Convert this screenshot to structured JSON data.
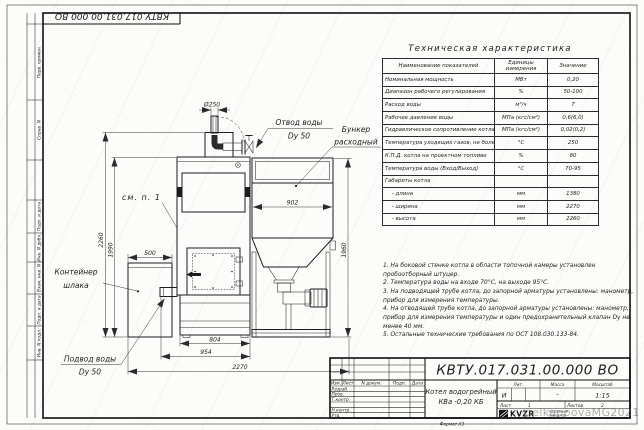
{
  "frame": {
    "top_doc_number": "КВТУ.017.031.00.000 ВО",
    "side_labels": [
      "Перв. примен.",
      "Справ. N",
      "Подп. и дата",
      "Инв. N дубл.",
      "Взам. инв. N",
      "Подп. и дата",
      "Инв. N подл."
    ]
  },
  "spec_table": {
    "title": "Техническая характеристика",
    "columns": [
      "Наименование показателей",
      "Единицы измерения",
      "Значение"
    ],
    "rows": [
      [
        "Номинальная мощность",
        "МВт",
        "0,20"
      ],
      [
        "Диапазон рабочего регулирования",
        "%",
        "50-100"
      ],
      [
        "Расход воды",
        "м³/ч",
        "7"
      ],
      [
        "Рабочее давление воды",
        "МПа (кгс/см²)",
        "0,6(6,0)"
      ],
      [
        "Гидравлическое сопротивление котла",
        "МПа (кгс/см²)",
        "0,02(0,2)"
      ],
      [
        "Температура уходящих газов, не более",
        "°С",
        "250"
      ],
      [
        "К.П.Д. котла на проектном топливе",
        "%",
        "80"
      ],
      [
        "Температура воды (Вход/Выход)",
        "°С",
        "70-95"
      ],
      [
        "Габариты котла",
        "",
        ""
      ],
      [
        "    - длина",
        "мм",
        "1380"
      ],
      [
        "    - ширина",
        "мм",
        "2270"
      ],
      [
        "    - высота",
        "мм",
        "2260"
      ]
    ]
  },
  "notes": [
    "1. На боковой стенке котла в области топочной камеры установлен пробоотборный штуцер.",
    "2. Температура воды на входе 70°С, на выходе 95°С.",
    "3. На подводящей трубе котла, до запорной арматуры установлены: манометр, прибор для измерения температуры.",
    "4. На отводящей трубе котла, до запорной арматуры установлены: манометр, прибор для измерения температуры и один предохранительный клапан Dу не менее 40 мм.",
    "5. Остальные технические требования по ОСТ 108.030.133-84."
  ],
  "drawing": {
    "labels": {
      "outlet_line1": "Отвод воды",
      "outlet_line2": "Dy 50",
      "bunker_line1": "Бункер",
      "bunker_line2": "расходный",
      "container_line1": "Контейнер",
      "container_line2": "шлака",
      "inlet_line1": "Подвод воды",
      "inlet_line2": "Dy 50",
      "see_note": "см. п. 1"
    },
    "dims": {
      "chimney_dia": "Ø250",
      "total_height": "2260",
      "boiler_height": "1990",
      "container_width": "500",
      "bunker_width": "902",
      "bunker_height": "1960",
      "base_width": "804",
      "boiler_width": "954",
      "total_width": "2270"
    }
  },
  "title_block": {
    "doc_number": "КВТУ.017.031.00.000 ВО",
    "product_line1": "Котел водогрейный",
    "product_line2": "КВа -0,20 КБ",
    "rev_header": {
      "izm": "Изм.",
      "list": "Лист",
      "doc": "N докум.",
      "podp": "Подп.",
      "data": "Дата"
    },
    "roles": [
      "Разраб.",
      "Пров.",
      "Т.контр.",
      "Н.контр.",
      "Утв."
    ],
    "lit_label": "Лит.",
    "mass_label": "Масса",
    "scale_label": "Масштаб",
    "lit_value": "И",
    "mass_value": "-",
    "scale_value": "1:15",
    "sheet_label": "Лист",
    "sheet_value": "1",
    "sheets_label": "Листов",
    "sheets_value": "2",
    "logo_text": "KVZR",
    "company_line1": "КОТЕЛЬНЫЙ",
    "company_line2": "ЗАВОД РЭП",
    "format_note": "Формат А3"
  },
  "watermark": "©elkappovaMG2021"
}
